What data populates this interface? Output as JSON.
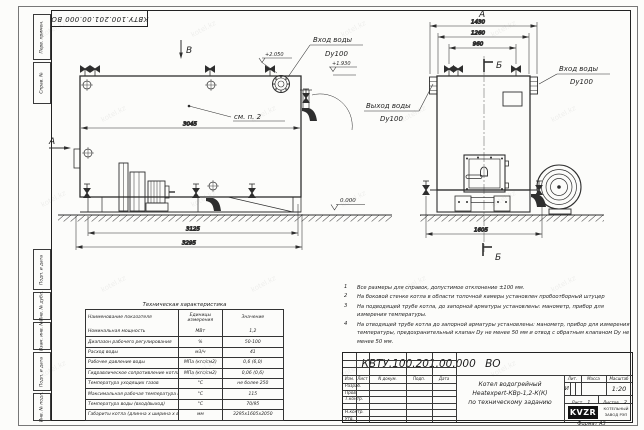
{
  "sheet": {
    "watermark": "kotel.kz",
    "format_label": "Формат  А3",
    "margin_labels": [
      "Перв. примен.",
      "Справ. №",
      "Подп. и дата",
      "Инв. № дубл.",
      "Взам. инв. №",
      "Подп. и дата",
      "Инв. № подл."
    ]
  },
  "views": {
    "side": {
      "view_letter": "В",
      "arrow_letter": "А",
      "see_note": "см. п. 2",
      "inlet_line1": "Вход воды",
      "inlet_line2": "Dy100",
      "elev_top": "+2.050",
      "elev_inlet": "+1.930",
      "elev_ground": "0.000",
      "dims": {
        "body": "3045",
        "frame": "3125",
        "overall": "3295"
      }
    },
    "front": {
      "title_letter": "А",
      "section_letter": "Б",
      "inlet_line1": "Вход воды",
      "inlet_line2": "Dy100",
      "outlet_line1": "Выход воды",
      "outlet_line2": "Dy100",
      "dims": {
        "overall": "1430",
        "body": "1260",
        "valves": "960",
        "base": "1605"
      }
    }
  },
  "tech_table": {
    "title": "Техническая характеристика",
    "headers": [
      "Наименование показателя",
      "Единицы измерения",
      "Значение"
    ],
    "rows": [
      [
        "Номинальная мощность",
        "МВт",
        "1,2"
      ],
      [
        "Диапазон рабочего регулирования",
        "%",
        "50-100"
      ],
      [
        "Расход воды",
        "м3/ч",
        "41"
      ],
      [
        "Рабочее давление воды",
        "МПа (кгс/см2)",
        "0,6 (6,0)"
      ],
      [
        "Гидравлическое сопротивление котла",
        "МПа (кгс/см2)",
        "0,06 (0,6)"
      ],
      [
        "Температура уходящих газов",
        "°С",
        "не более 250"
      ],
      [
        "Максимальная рабочая температура воды",
        "°С",
        "115"
      ],
      [
        "Температура воды (вход/выход)",
        "°С",
        "70/95"
      ],
      [
        "Габариты котла (длинна х ширина х высота)",
        "мм",
        "3295х1605х2050"
      ]
    ]
  },
  "notes": [
    {
      "num": "1",
      "text": "Все размеры для справок, допустимое отклонение ±100 мм."
    },
    {
      "num": "2",
      "text": "На боковой стенке котла в области топочной камеры установлен пробоотборный штуцер"
    },
    {
      "num": "3",
      "text": "На подводящей трубе котла, до запорной арматуры установлены: манометр, прибор для измерения температуры."
    },
    {
      "num": "4",
      "text": "На отводящей трубе котла до запорной арматуры установлены: манометр, прибор для измерения температуры, предохранительный клапан Dy не менее 50 мм и отвод с обратным клапаном Dy не менее 50 мм."
    }
  ],
  "title_block": {
    "doc_number": "КВТУ.100.201.00.000 ВО",
    "product_name": [
      "Котел водогрейный",
      "Heatexpert-КВр-1,2-К(К)",
      "по техническому заданию"
    ],
    "header_cols": [
      "Изм.",
      "Лист",
      "N докум.",
      "Подп.",
      "Дата"
    ],
    "sign_rows": [
      "Разраб.",
      "Пров.",
      "Т.контр.",
      " ",
      "Н.контр.",
      "Утв."
    ],
    "lit_label": "Лит.",
    "lit_value": "И",
    "mass_label": "Масса",
    "scale_label": "Масштаб",
    "scale_value": "1:20",
    "sheet_label": "Лист",
    "sheet_value": "1",
    "sheets_label": "Листов",
    "sheets_value": "2",
    "logo_text": "KVZR",
    "company": [
      "КОТЕЛЬНЫЙ",
      "ЗАВОД РЭП"
    ]
  }
}
